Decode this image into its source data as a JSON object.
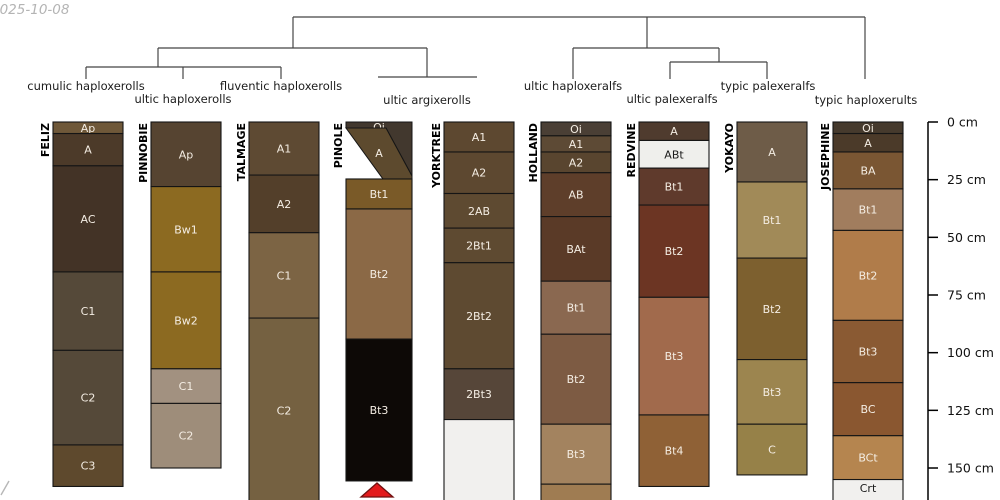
{
  "meta": {
    "date_stamp": "2025-10-08",
    "corner_mark": {
      "x1": 1,
      "y1": 495,
      "x2": 9,
      "y2": 481,
      "color": "#b7b7b7"
    }
  },
  "chart_data": {
    "type": "table",
    "description": "Dendrogram of soil taxonomic groups above nine soil profile sketches with a depth axis in cm",
    "dendrogram": {
      "stroke": "#454545",
      "segments": [
        [
          293,
          17,
          865,
          17
        ],
        [
          293,
          17,
          293,
          48
        ],
        [
          647,
          17,
          647,
          48
        ],
        [
          865,
          17,
          865,
          79
        ],
        [
          158,
          48,
          427,
          48
        ],
        [
          158,
          48,
          158,
          67
        ],
        [
          427,
          48,
          427,
          77
        ],
        [
          86,
          67,
          281,
          67
        ],
        [
          86,
          67,
          86,
          79
        ],
        [
          183,
          67,
          183,
          79
        ],
        [
          281,
          67,
          281,
          79
        ],
        [
          378,
          77,
          477,
          77
        ],
        [
          573,
          48,
          719,
          48
        ],
        [
          573,
          48,
          573,
          79
        ],
        [
          719,
          48,
          719,
          62
        ],
        [
          670,
          62,
          767,
          62
        ],
        [
          670,
          62,
          670,
          79
        ],
        [
          767,
          62,
          767,
          79
        ]
      ],
      "labels": [
        {
          "text": "cumulic haploxerolls",
          "x": 86,
          "y": 90
        },
        {
          "text": "ultic haploxerolls",
          "x": 183,
          "y": 103
        },
        {
          "text": "fluventic haploxerolls",
          "x": 281,
          "y": 90
        },
        {
          "text": "ultic argixerolls",
          "x": 427,
          "y": 104
        },
        {
          "text": "ultic haploxeralfs",
          "x": 573,
          "y": 90
        },
        {
          "text": "ultic palexeralfs",
          "x": 672,
          "y": 103
        },
        {
          "text": "typic palexeralfs",
          "x": 768,
          "y": 90
        },
        {
          "text": "typic haploxerults",
          "x": 866,
          "y": 104
        }
      ]
    },
    "depth_axis": {
      "x": 928,
      "top_y": 122,
      "px_per_cm": 2.3067,
      "unit": "cm",
      "ticks": [
        {
          "cm": 0,
          "label": "0 cm"
        },
        {
          "cm": 25,
          "label": "25 cm"
        },
        {
          "cm": 50,
          "label": "50 cm"
        },
        {
          "cm": 75,
          "label": "75 cm"
        },
        {
          "cm": 100,
          "label": "100 cm"
        },
        {
          "cm": 125,
          "label": "125 cm"
        },
        {
          "cm": 150,
          "label": "150 cm"
        }
      ]
    },
    "profiles": [
      {
        "name": "FELIZ",
        "x": 53,
        "width": 70,
        "horizons": [
          {
            "label": "Ap",
            "top_cm": 0,
            "bottom_cm": 5,
            "color": "#6f5839"
          },
          {
            "label": "A",
            "top_cm": 5,
            "bottom_cm": 19,
            "color": "#4c3a29"
          },
          {
            "label": "AC",
            "top_cm": 19,
            "bottom_cm": 65,
            "color": "#433326"
          },
          {
            "label": "C1",
            "top_cm": 65,
            "bottom_cm": 99,
            "color": "#554939"
          },
          {
            "label": "C2",
            "top_cm": 99,
            "bottom_cm": 140,
            "color": "#554939"
          },
          {
            "label": "C3",
            "top_cm": 140,
            "bottom_cm": 158,
            "color": "#5e492d"
          }
        ]
      },
      {
        "name": "PINNOBIE",
        "x": 151,
        "width": 70,
        "horizons": [
          {
            "label": "Ap",
            "top_cm": 0,
            "bottom_cm": 28,
            "color": "#564431"
          },
          {
            "label": "Bw1",
            "top_cm": 28,
            "bottom_cm": 65,
            "color": "#8c6a21"
          },
          {
            "label": "Bw2",
            "top_cm": 65,
            "bottom_cm": 107,
            "color": "#8c6a21"
          },
          {
            "label": "C1",
            "top_cm": 107,
            "bottom_cm": 122,
            "color": "#a29180"
          },
          {
            "label": "C2",
            "top_cm": 122,
            "bottom_cm": 150,
            "color": "#9e8d7a"
          }
        ]
      },
      {
        "name": "TALMAGE",
        "x": 249,
        "width": 70,
        "horizons": [
          {
            "label": "A1",
            "top_cm": 0,
            "bottom_cm": 23,
            "color": "#5e4a33"
          },
          {
            "label": "A2",
            "top_cm": 23,
            "bottom_cm": 48,
            "color": "#533f2a"
          },
          {
            "label": "C1",
            "top_cm": 48,
            "bottom_cm": 85,
            "color": "#7c6444"
          },
          {
            "label": "C2",
            "top_cm": 85,
            "bottom_cm": 165,
            "color": "#756141"
          }
        ]
      },
      {
        "name": "PINOLE",
        "x": 346,
        "width": 66,
        "marker": {
          "points": "377,483 361,497 393,497",
          "fill": "#e31a1c",
          "stroke": "#701010"
        },
        "horizons": [
          {
            "label": "Oi",
            "polygon": "346,122 412,122 412,176 386,128 346,128",
            "label_y": 131,
            "color": "#42382e"
          },
          {
            "label": "A",
            "polygon": "346,128 386,128 412,176 412,179 383,179",
            "label_y": 157,
            "color": "#5d4a2e"
          },
          {
            "label": "Bt1",
            "top_cm": 24.7,
            "bottom_cm": 37.7,
            "color": "#7a5a28"
          },
          {
            "label": "Bt2",
            "top_cm": 37.7,
            "bottom_cm": 94.1,
            "color": "#8b6946"
          },
          {
            "label": "Bt3",
            "top_cm": 94.1,
            "bottom_cm": 155.6,
            "color": "#0d0906"
          }
        ]
      },
      {
        "name": "YORKTREE",
        "x": 444,
        "width": 70,
        "horizons": [
          {
            "label": "A1",
            "top_cm": 0,
            "bottom_cm": 13,
            "color": "#5d4830"
          },
          {
            "label": "A2",
            "top_cm": 13,
            "bottom_cm": 31,
            "color": "#5d4830"
          },
          {
            "label": "2AB",
            "top_cm": 31,
            "bottom_cm": 46,
            "color": "#5e4a31"
          },
          {
            "label": "2Bt1",
            "top_cm": 46,
            "bottom_cm": 61,
            "color": "#5e4a31",
            "small": true
          },
          {
            "label": "2Bt2",
            "top_cm": 61,
            "bottom_cm": 107,
            "color": "#5e4a31",
            "small": true
          },
          {
            "label": "2Bt3",
            "top_cm": 107,
            "bottom_cm": 129,
            "color": "#564639",
            "small": true
          },
          {
            "label": "",
            "top_cm": 129,
            "bottom_cm": 165,
            "color": "#f1f0ee"
          }
        ]
      },
      {
        "name": "HOLLAND",
        "x": 541,
        "width": 70,
        "horizons": [
          {
            "label": "Oi",
            "top_cm": 0,
            "bottom_cm": 6,
            "color": "#4a3f35"
          },
          {
            "label": "A1",
            "top_cm": 6,
            "bottom_cm": 13,
            "color": "#5d4a35"
          },
          {
            "label": "A2",
            "top_cm": 13,
            "bottom_cm": 22,
            "color": "#59452f"
          },
          {
            "label": "AB",
            "top_cm": 22,
            "bottom_cm": 41,
            "color": "#5e3e2a"
          },
          {
            "label": "BAt",
            "top_cm": 41,
            "bottom_cm": 69,
            "color": "#5a3a27"
          },
          {
            "label": "Bt1",
            "top_cm": 69,
            "bottom_cm": 92,
            "color": "#8a6850"
          },
          {
            "label": "Bt2",
            "top_cm": 92,
            "bottom_cm": 131,
            "color": "#7d5b43"
          },
          {
            "label": "Bt3",
            "top_cm": 131,
            "bottom_cm": 157,
            "color": "#a3835f"
          },
          {
            "label": "",
            "top_cm": 157,
            "bottom_cm": 165,
            "color": "#9f7c52"
          }
        ]
      },
      {
        "name": "REDVINE",
        "x": 639,
        "width": 70,
        "horizons": [
          {
            "label": "A",
            "top_cm": 0,
            "bottom_cm": 8,
            "color": "#4f3b2e"
          },
          {
            "label": "ABt",
            "top_cm": 8,
            "bottom_cm": 20,
            "color": "#efefec",
            "label_color": "#1a1a1a"
          },
          {
            "label": "Bt1",
            "top_cm": 20,
            "bottom_cm": 36,
            "color": "#5f3a2c"
          },
          {
            "label": "Bt2",
            "top_cm": 36,
            "bottom_cm": 76,
            "color": "#6c3523"
          },
          {
            "label": "Bt3",
            "top_cm": 76,
            "bottom_cm": 127,
            "color": "#a16a4c"
          },
          {
            "label": "Bt4",
            "top_cm": 127,
            "bottom_cm": 158,
            "color": "#8f6136"
          }
        ]
      },
      {
        "name": "YOKAYO",
        "x": 737,
        "width": 70,
        "horizons": [
          {
            "label": "A",
            "top_cm": 0,
            "bottom_cm": 26,
            "color": "#6e5c48"
          },
          {
            "label": "Bt1",
            "top_cm": 26,
            "bottom_cm": 59,
            "color": "#a18a58"
          },
          {
            "label": "Bt2",
            "top_cm": 59,
            "bottom_cm": 103,
            "color": "#7d602f"
          },
          {
            "label": "Bt3",
            "top_cm": 103,
            "bottom_cm": 131,
            "color": "#9c854f"
          },
          {
            "label": "C",
            "top_cm": 131,
            "bottom_cm": 153,
            "color": "#968148"
          }
        ]
      },
      {
        "name": "JOSEPHINE",
        "x": 833,
        "width": 70,
        "horizons": [
          {
            "label": "Oi",
            "top_cm": 0,
            "bottom_cm": 5,
            "color": "#463a2d"
          },
          {
            "label": "A",
            "top_cm": 5,
            "bottom_cm": 13,
            "color": "#4b3a29"
          },
          {
            "label": "BA",
            "top_cm": 13,
            "bottom_cm": 29,
            "color": "#7a5633"
          },
          {
            "label": "Bt1",
            "top_cm": 29,
            "bottom_cm": 47,
            "color": "#a17d5e"
          },
          {
            "label": "Bt2",
            "top_cm": 47,
            "bottom_cm": 86,
            "color": "#b07c4a"
          },
          {
            "label": "Bt3",
            "top_cm": 86,
            "bottom_cm": 113,
            "color": "#8a5a33"
          },
          {
            "label": "BC",
            "top_cm": 113,
            "bottom_cm": 136,
            "color": "#8a5730"
          },
          {
            "label": "BCt",
            "top_cm": 136,
            "bottom_cm": 155,
            "color": "#b5854f"
          },
          {
            "label": "Crt",
            "top_cm": 155,
            "bottom_cm": 165,
            "color": "#f1f0ee",
            "label_color": "#1a1a1a",
            "label_y": 492
          }
        ]
      }
    ]
  }
}
